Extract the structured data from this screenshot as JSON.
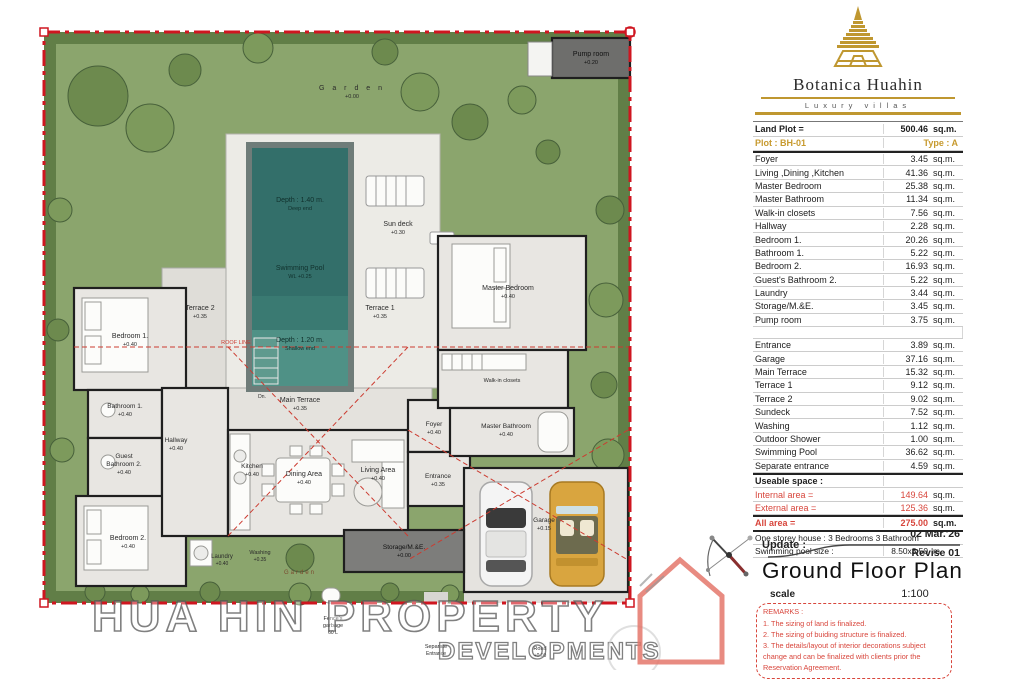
{
  "brand": {
    "name": "Botanica Huahin",
    "tagline": "Luxury villas"
  },
  "summary": {
    "land_plot_label": "Land Plot =",
    "land_plot_value": "500.46",
    "land_plot_unit": "sq.m.",
    "plot": "Plot : BH-01",
    "type": "Type : A"
  },
  "areas_internal": [
    {
      "name": "Foyer",
      "value": "3.45",
      "unit": "sq.m."
    },
    {
      "name": "Living ,Dining ,Kitchen",
      "value": "41.36",
      "unit": "sq.m."
    },
    {
      "name": "Master Bedroom",
      "value": "25.38",
      "unit": "sq.m."
    },
    {
      "name": "Master Bathroom",
      "value": "11.34",
      "unit": "sq.m."
    },
    {
      "name": "Walk-in closets",
      "value": "7.56",
      "unit": "sq.m."
    },
    {
      "name": "Hallway",
      "value": "2.28",
      "unit": "sq.m."
    },
    {
      "name": "Bedroom 1.",
      "value": "20.26",
      "unit": "sq.m."
    },
    {
      "name": "Bathroom 1.",
      "value": "5.22",
      "unit": "sq.m."
    },
    {
      "name": "Bedroom 2.",
      "value": "16.93",
      "unit": "sq.m."
    },
    {
      "name": "Guest's Bathroom 2.",
      "value": "5.22",
      "unit": "sq.m."
    },
    {
      "name": "Laundry",
      "value": "3.44",
      "unit": "sq.m."
    },
    {
      "name": "Storage/M.&E.",
      "value": "3.45",
      "unit": "sq.m."
    },
    {
      "name": "Pump room",
      "value": "3.75",
      "unit": "sq.m."
    }
  ],
  "areas_external": [
    {
      "name": "Entrance",
      "value": "3.89",
      "unit": "sq.m."
    },
    {
      "name": "Garage",
      "value": "37.16",
      "unit": "sq.m."
    },
    {
      "name": "Main Terrace",
      "value": "15.32",
      "unit": "sq.m."
    },
    {
      "name": "Terrace 1",
      "value": "9.12",
      "unit": "sq.m."
    },
    {
      "name": "Terrace 2",
      "value": "9.02",
      "unit": "sq.m."
    },
    {
      "name": "Sundeck",
      "value": "7.52",
      "unit": "sq.m."
    },
    {
      "name": "Washing",
      "value": "1.12",
      "unit": "sq.m."
    },
    {
      "name": "Outdoor Shower",
      "value": "1.00",
      "unit": "sq.m."
    },
    {
      "name": "Swimming Pool",
      "value": "36.62",
      "unit": "sq.m."
    },
    {
      "name": "Separate entrance",
      "value": "4.59",
      "unit": "sq.m."
    }
  ],
  "useable": {
    "header": "Useable space :",
    "internal_label": "Internal area =",
    "internal_value": "149.64",
    "external_label": "External area =",
    "external_value": "125.36",
    "all_label": "All area =",
    "all_value": "275.00",
    "unit": "sq.m."
  },
  "house_info": {
    "desc": "One storey house : 3 Bedrooms  3 Bathroom",
    "pool_label": "Swimming pool size :",
    "pool_value": "8.50x3.50",
    "pool_unit": "m."
  },
  "title_block": {
    "update_label": "Update :",
    "date": "02 Mar.'26",
    "revise": "Revise 01",
    "title": "Ground Floor Plan",
    "scale_label": "scale",
    "scale_value": "1:100"
  },
  "remarks": {
    "title": "REMARKS :",
    "items": [
      "1. The sizing of land is finalized.",
      "2. The sizing of buiding structure is finalized.",
      "3. The details/layout of interior decorations subject change and can be finalized with clients prior the Reservation Agreement."
    ]
  },
  "watermark": {
    "line1": "HUA HIN PROPERTY",
    "line2": "DEVELOPMENTS"
  },
  "plan": {
    "garden": {
      "l1": "G a r d e n",
      "l2": "+0.00"
    },
    "garden2": {
      "l1": "Garden"
    },
    "pump_room": {
      "l1": "Pump room",
      "l2": "+0.20"
    },
    "sun_deck": {
      "l1": "Sun deck",
      "l2": "+0.30"
    },
    "pool_deep": {
      "l1": "Depth : 1.40 m.",
      "l2": "Deep end"
    },
    "pool_mid": {
      "l1": "Swimming Pool",
      "l2": "WL +0.25"
    },
    "pool_shallow": {
      "l1": "Depth : 1.20 m.",
      "l2": "Shallow end"
    },
    "pool_dn": {
      "l1": "Dn."
    },
    "terrace1": {
      "l1": "Terrace 1",
      "l2": "+0.35"
    },
    "terrace2": {
      "l1": "Terrace 2",
      "l2": "+0.35"
    },
    "main_terrace": {
      "l1": "Main Terrace",
      "l2": "+0.35"
    },
    "roof_line": {
      "l1": "ROOF LINE"
    },
    "bedroom1": {
      "l1": "Bedroom 1.",
      "l2": "+0.40"
    },
    "bathroom1": {
      "l1": "Bathroom 1.",
      "l2": "+0.40"
    },
    "guest_bath": {
      "l1": "Guest",
      "l2": "Bathroom 2.",
      "l3": "+0.40"
    },
    "hallway": {
      "l1": "Hallway",
      "l2": "+0.40"
    },
    "bedroom2": {
      "l1": "Bedroom 2.",
      "l2": "+0.40"
    },
    "kitchen": {
      "l1": "Kitchen",
      "l2": "+0.40"
    },
    "laundry": {
      "l1": "Laundry",
      "l2": "+0.40"
    },
    "washing": {
      "l1": "Washing",
      "l2": "+0.35"
    },
    "dining": {
      "l1": "Dining Area",
      "l2": "+0.40"
    },
    "living": {
      "l1": "Living Area",
      "l2": "+0.40"
    },
    "storage": {
      "l1": "Storage/M.&E.",
      "l2": "+0.00"
    },
    "foyer": {
      "l1": "Foyer",
      "l2": "+0.40"
    },
    "entrance": {
      "l1": "Entrance",
      "l2": "+0.35"
    },
    "master_bedroom": {
      "l1": "Master Bedroom",
      "l2": "+0.40"
    },
    "walkin": {
      "l1": "Walk-in closets"
    },
    "master_bath": {
      "l1": "Master Bathroom",
      "l2": "+0.40"
    },
    "garage": {
      "l1": "Garage",
      "l2": "+0.15"
    },
    "fence": {
      "l1": "Fence's",
      "l2": "garbage",
      "l3": "60 L"
    },
    "sep_entrance": {
      "l1": "Separate",
      "l2": "Entrance"
    },
    "road": {
      "l1": "Road",
      "l2": "+0.00"
    }
  },
  "colors": {
    "boundary_red": "#cf1620",
    "roof_red": "#cc3b30",
    "accent_gold": "#bf9730",
    "table_red": "#d8463c",
    "garden_green": "#8ba56d",
    "pool_teal": "#336f6a"
  }
}
